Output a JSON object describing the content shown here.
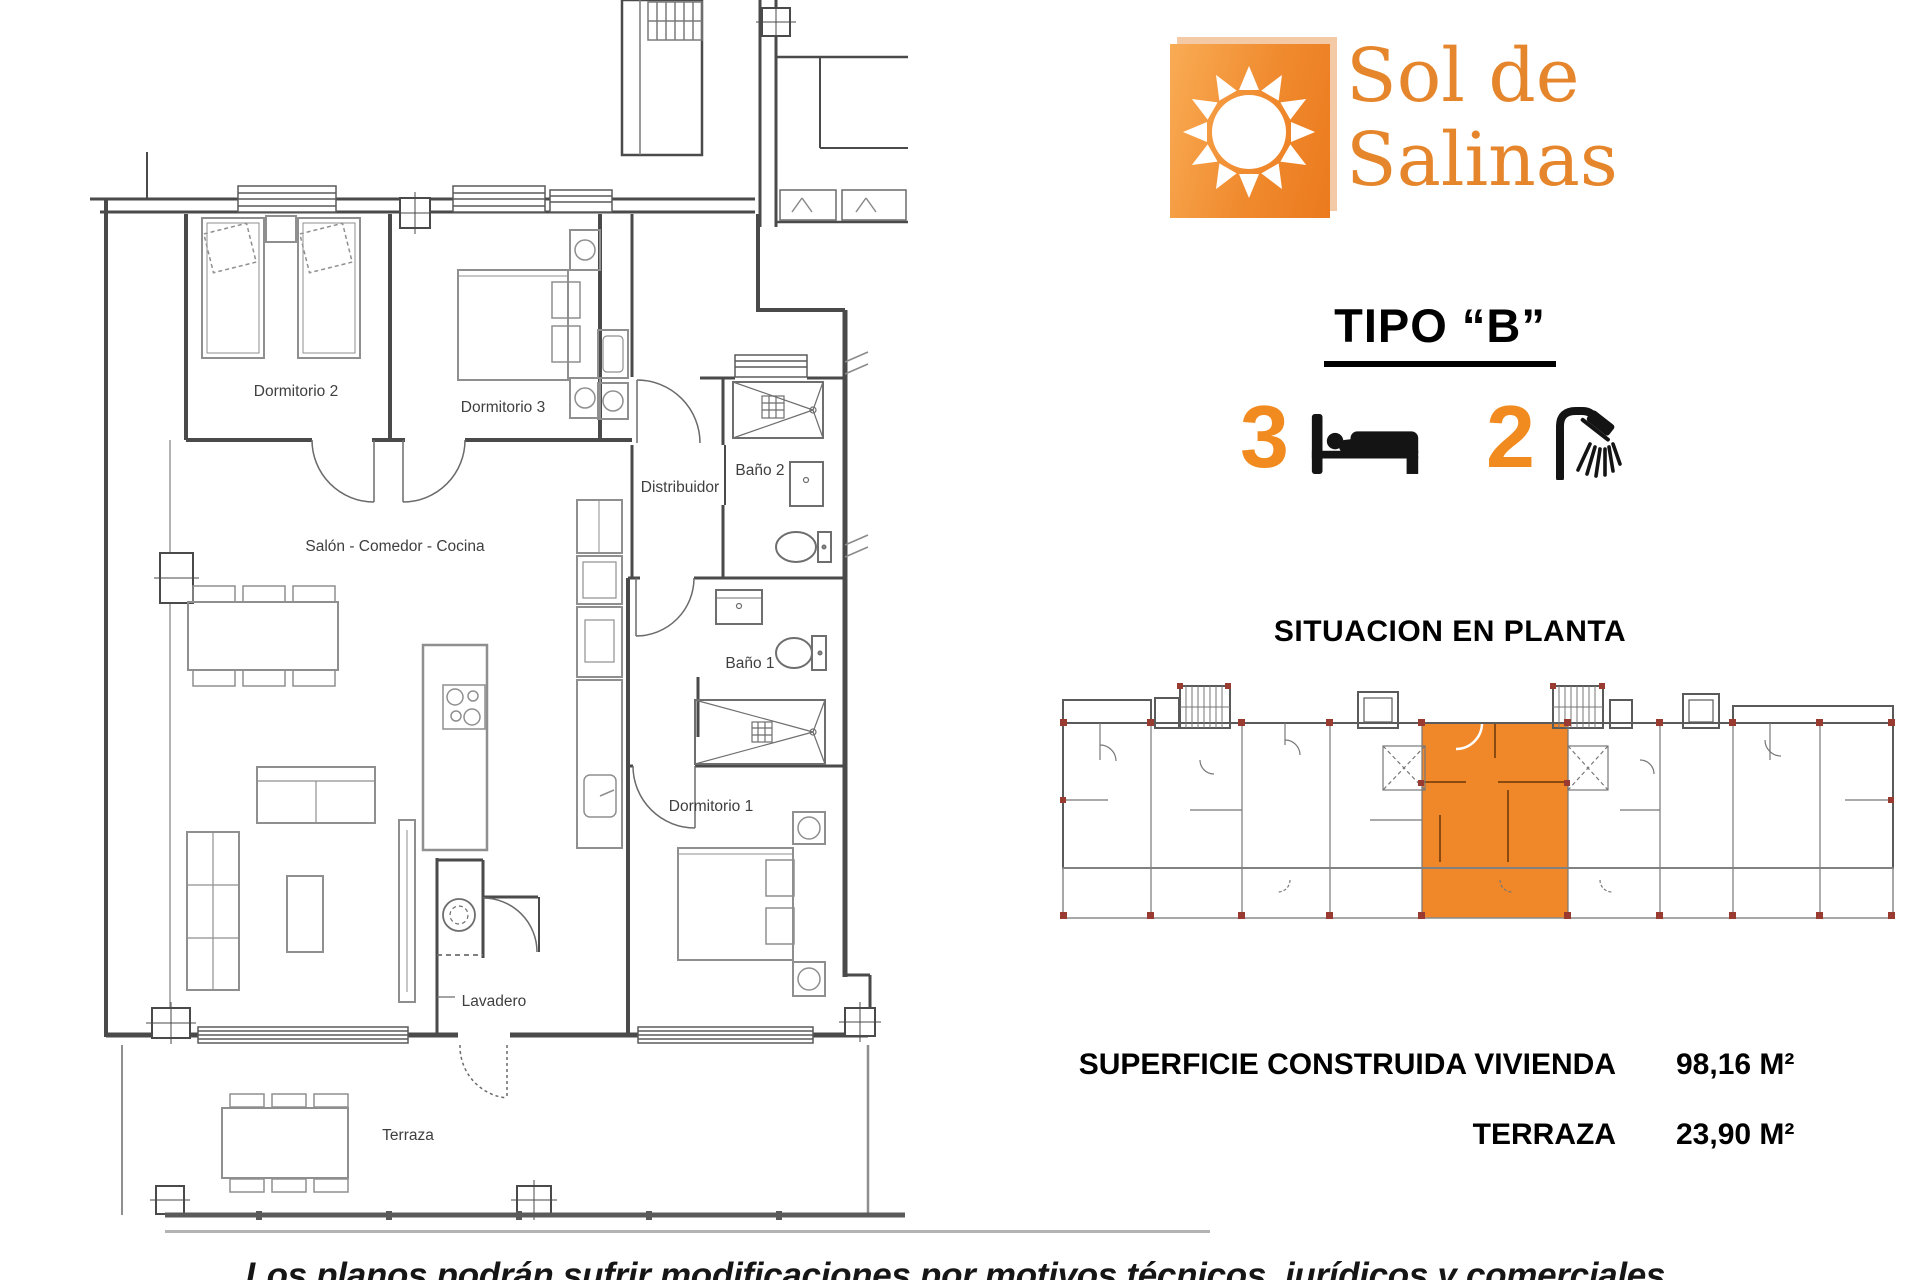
{
  "logo": {
    "line1": "Sol de",
    "line2": "Salinas",
    "text_color": "#e6862c",
    "square_gradient": [
      "#f9ac55",
      "#ec7a1e"
    ],
    "shadow_color": "#f3c9a6"
  },
  "header": {
    "type_title": "TIPO “B”",
    "bedroom_count": "3",
    "bathroom_count": "2",
    "count_color": "#f28b1f"
  },
  "situation": {
    "title": "SITUACION EN PLANTA",
    "highlight_color": "#f0882a",
    "marker_color": "#993b31"
  },
  "areas": {
    "built_label": "SUPERFICIE CONSTRUIDA VIVIENDA",
    "built_value": "98,16 M²",
    "terrace_label": "TERRAZA",
    "terrace_value": "23,90 M²"
  },
  "floorplan": {
    "labels": {
      "dormitorio2": "Dormitorio 2",
      "dormitorio3": "Dormitorio 3",
      "bano2": "Baño 2",
      "distribuidor": "Distribuidor",
      "salon": "Salón - Comedor - Cocina",
      "bano1": "Baño 1",
      "dormitorio1": "Dormitorio 1",
      "lavadero": "Lavadero",
      "terraza": "Terraza"
    }
  },
  "disclaimer": "Los planos podrán sufrir modificaciones por motivos técnicos, jurídicos y comerciales."
}
